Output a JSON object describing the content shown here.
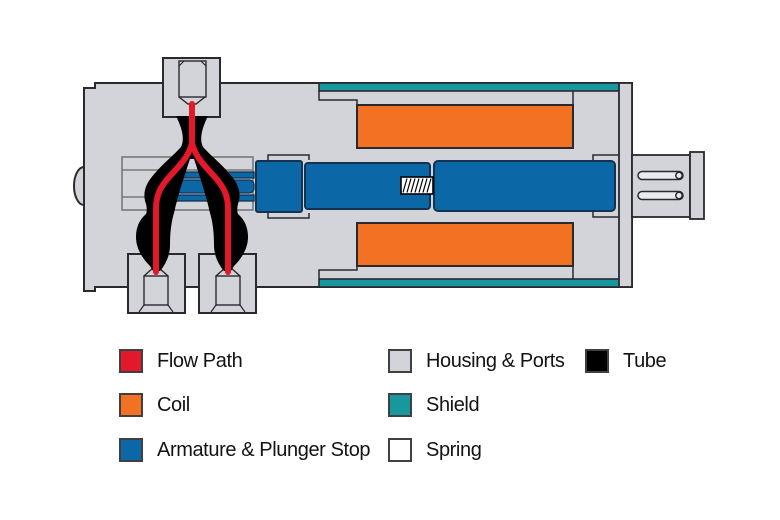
{
  "diagram": {
    "type": "solenoid-valve-cross-section-diagram"
  },
  "colors": {
    "flow_path": "#e4182b",
    "coil": "#f37123",
    "armature": "#0c67a6",
    "armature_outline": "#14324f",
    "housing": "#d2d4da",
    "shield": "#17989f",
    "spring": "#ffffff",
    "tube": "#000000",
    "outline": "#2a292d",
    "detail_line": "#77787b",
    "slot_fill": "#e9ebef",
    "text": "#131313"
  },
  "legend": {
    "items": [
      {
        "label": "Flow Path",
        "color": "#e4182b"
      },
      {
        "label": "Coil",
        "color": "#f37123"
      },
      {
        "label": "Armature & Plunger Stop",
        "color": "#0c67a6"
      },
      {
        "label": "Housing & Ports",
        "color": "#d2d4da"
      },
      {
        "label": "Shield",
        "color": "#17989f"
      },
      {
        "label": "Spring",
        "color": "#ffffff"
      },
      {
        "label": "Tube",
        "color": "#000000"
      }
    ]
  }
}
